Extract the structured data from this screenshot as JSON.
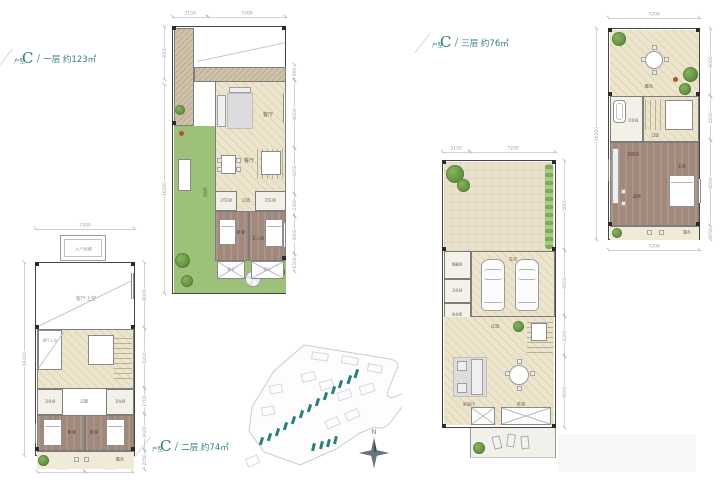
{
  "colors": {
    "accent_teal": "#2e7d7d",
    "floor_cream": "#ece4cb",
    "floor_bedroom": "#a1887a",
    "garden_green": "#9dc179",
    "paving": "#c7bba5",
    "wall": "#454545",
    "site_highlight": "#2e7d7d"
  },
  "captions": {
    "floor1": {
      "unit_stack": "户型",
      "letter": "C",
      "slash": "/",
      "label": "一层 约123㎡"
    },
    "floor2": {
      "unit_stack": "户型",
      "letter": "C",
      "slash": "/",
      "label": "二层 约74㎡"
    },
    "floor3": {
      "unit_stack": "户型",
      "letter": "C",
      "slash": "/",
      "label": "三层 约76㎡"
    }
  },
  "floor1": {
    "dims": {
      "top": [
        "3150",
        "7200"
      ],
      "left": [
        "3900",
        "16200"
      ],
      "right": [
        "900",
        "6000",
        "4200",
        "2300",
        "3900",
        "1500"
      ]
    },
    "rooms": {
      "living": "客厅",
      "dining": "餐厅",
      "bath1": "卫生间",
      "hall": "过道",
      "bath2": "卫生间",
      "bed": "卧室",
      "master": "主人房",
      "garden": "花园",
      "patio_left": "露台",
      "patio_right": "露台"
    }
  },
  "floor2": {
    "dims": {
      "top": [
        "7200"
      ],
      "left": [
        "16200"
      ],
      "right": [
        "8000",
        "4200",
        "2700",
        "3000",
        "2050"
      ],
      "bottom": [
        "3600",
        "3600"
      ]
    },
    "rooms": {
      "canopy": "入户雨棚",
      "void_living": "客厅上空",
      "void_dining": "餐厅上空",
      "bath1": "卫生间",
      "hall": "过道",
      "bath2": "卫生间",
      "bed1": "卧室",
      "bed2": "卧室",
      "terrace": "露台"
    }
  },
  "floor3": {
    "dims": {
      "top": [
        "7200"
      ],
      "left": [
        "16200"
      ],
      "right": [
        "6000",
        "4200",
        "6000",
        "2050"
      ],
      "bottom": [
        "7200"
      ]
    },
    "rooms": {
      "terrace_top": "露台",
      "bath": "卫生间",
      "hall": "过道",
      "closet": "衣帽间",
      "master": "主卧",
      "sitting": "起居",
      "terrace_bottom": "露台"
    }
  },
  "basement": {
    "dims": {
      "top": [
        "3150",
        "7200"
      ],
      "right": [
        "5600",
        "6000",
        "4200",
        "6000"
      ]
    },
    "rooms": {
      "garage": "车库",
      "storage": "储藏间",
      "bath": "卫生间",
      "laundry": "洗衣房",
      "hall": "过道",
      "family": "家庭厅",
      "tea": "茶室"
    }
  },
  "compass": {
    "north": "N"
  }
}
